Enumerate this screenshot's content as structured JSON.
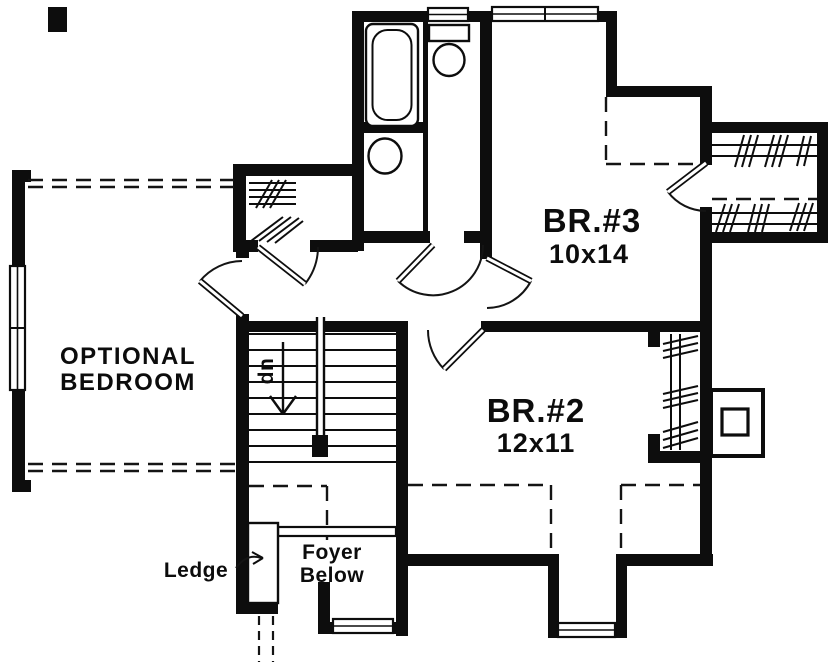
{
  "rooms": {
    "br3": {
      "name": "BR.#3",
      "dims": "10x14"
    },
    "br2": {
      "name": "BR.#2",
      "dims": "12x11"
    },
    "optional": {
      "line1": "OPTIONAL",
      "line2": "BEDROOM"
    }
  },
  "labels": {
    "ledge": "Ledge",
    "foyer_line1": "Foyer",
    "foyer_line2": "Below",
    "stairs_direction": "dn"
  },
  "colors": {
    "ink": "#0d0d0d",
    "paper": "#ffffff"
  }
}
